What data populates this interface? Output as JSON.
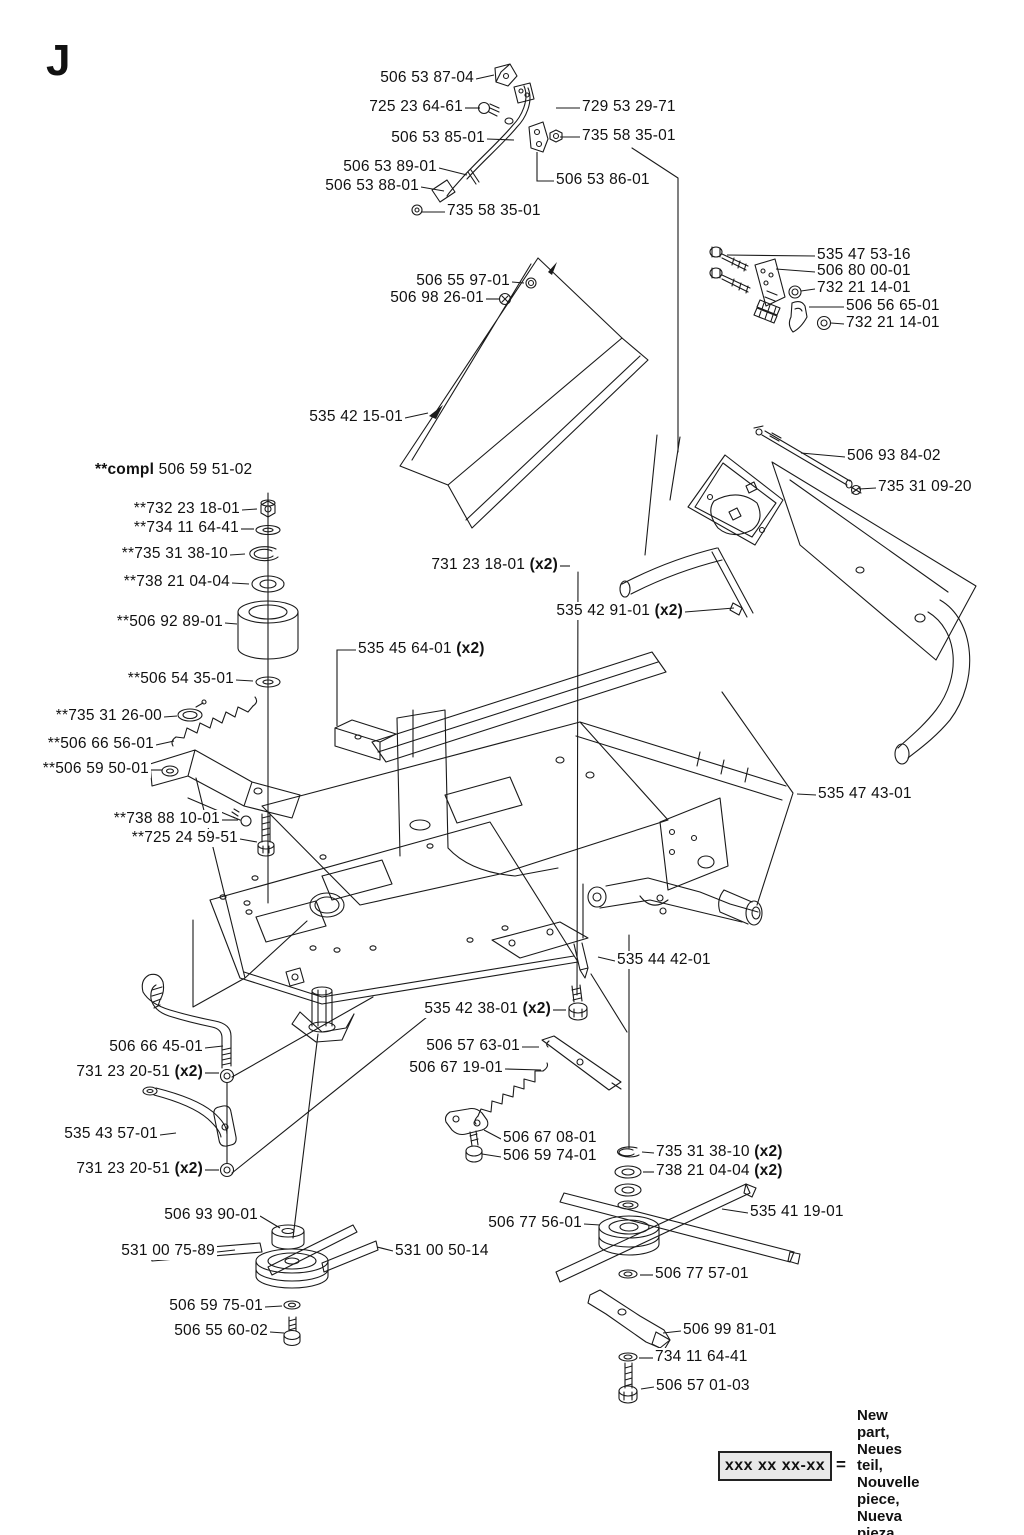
{
  "page": {
    "title_letter": "J",
    "background": "#ffffff",
    "line_color": "#1a1a1a"
  },
  "legend": {
    "box_label": "xxx xx xx-xx",
    "equals": "=",
    "lines": [
      "New part,",
      "Neues teil,",
      "Nouvelle piece,",
      "Nueva pieza,",
      "Ny detalj"
    ]
  },
  "parts_labels": [
    {
      "text": "506 53 87-04",
      "x": 474,
      "y": 79,
      "align": "r",
      "leader": [
        [
          476,
          79
        ],
        [
          494,
          75
        ]
      ]
    },
    {
      "text": "725 23 64-61",
      "x": 463,
      "y": 108,
      "align": "r",
      "leader": [
        [
          465,
          108
        ],
        [
          480,
          108
        ]
      ]
    },
    {
      "text": "729 53 29-71",
      "x": 582,
      "y": 108,
      "align": "l",
      "leader": [
        [
          556,
          108
        ],
        [
          580,
          108
        ]
      ]
    },
    {
      "text": "506 53 85-01",
      "x": 485,
      "y": 139,
      "align": "r",
      "leader": [
        [
          487,
          139
        ],
        [
          514,
          140
        ]
      ]
    },
    {
      "text": "735 58 35-01",
      "x": 582,
      "y": 137,
      "align": "l",
      "leader": [
        [
          560,
          137
        ],
        [
          580,
          137
        ]
      ]
    },
    {
      "text": "506 53 89-01",
      "x": 437,
      "y": 168,
      "align": "r",
      "leader": [
        [
          439,
          168
        ],
        [
          467,
          175
        ]
      ]
    },
    {
      "text": "506 53 88-01",
      "x": 419,
      "y": 187,
      "align": "r",
      "leader": [
        [
          421,
          187
        ],
        [
          444,
          191
        ]
      ]
    },
    {
      "text": "506 53 86-01",
      "x": 556,
      "y": 181,
      "align": "l",
      "leader": [
        [
          537,
          152
        ],
        [
          537,
          181
        ],
        [
          554,
          181
        ]
      ]
    },
    {
      "text": "735 58 35-01",
      "x": 447,
      "y": 212,
      "align": "l",
      "leader": [
        [
          421,
          212
        ],
        [
          445,
          212
        ]
      ]
    },
    {
      "text": "535 47 53-16",
      "x": 817,
      "y": 256,
      "align": "l",
      "leader": [
        [
          727,
          255
        ],
        [
          815,
          256
        ]
      ]
    },
    {
      "text": "506 80 00-01",
      "x": 817,
      "y": 272,
      "align": "l",
      "leader": [
        [
          776,
          269
        ],
        [
          815,
          272
        ]
      ]
    },
    {
      "text": "732 21 14-01",
      "x": 817,
      "y": 289,
      "align": "l",
      "leader": [
        [
          801,
          291
        ],
        [
          815,
          289
        ]
      ]
    },
    {
      "text": "506 56 65-01",
      "x": 846,
      "y": 307,
      "align": "l",
      "leader": [
        [
          809,
          307
        ],
        [
          844,
          307
        ]
      ]
    },
    {
      "text": "732 21 14-01",
      "x": 846,
      "y": 324,
      "align": "l",
      "leader": [
        [
          831,
          323
        ],
        [
          844,
          324
        ]
      ]
    },
    {
      "text": "506 55 97-01",
      "x": 510,
      "y": 282,
      "align": "r",
      "leader": [
        [
          512,
          282
        ],
        [
          524,
          283
        ]
      ]
    },
    {
      "text": "506 98 26-01",
      "x": 484,
      "y": 299,
      "align": "r",
      "leader": [
        [
          486,
          299
        ],
        [
          500,
          299
        ]
      ]
    },
    {
      "text": "535 42 15-01",
      "x": 403,
      "y": 418,
      "align": "r",
      "leader": [
        [
          405,
          418
        ],
        [
          428,
          413
        ]
      ]
    },
    {
      "text": "506 93 84-02",
      "x": 847,
      "y": 457,
      "align": "l",
      "leader": [
        [
          801,
          453
        ],
        [
          845,
          457
        ]
      ]
    },
    {
      "text": "735 31 09-20",
      "x": 878,
      "y": 488,
      "align": "l",
      "leader": [
        [
          859,
          489
        ],
        [
          876,
          488
        ]
      ]
    },
    {
      "pre": "**compl ",
      "text": "506 59 51-02",
      "x": 95,
      "y": 471,
      "align": "l"
    },
    {
      "text": "**732 23 18-01",
      "x": 240,
      "y": 510,
      "align": "r",
      "leader": [
        [
          242,
          510
        ],
        [
          257,
          509
        ]
      ]
    },
    {
      "text": "**734 11 64-41",
      "x": 239,
      "y": 529,
      "align": "r",
      "leader": [
        [
          241,
          529
        ],
        [
          254,
          529
        ]
      ]
    },
    {
      "text": "**735 31 38-10",
      "x": 228,
      "y": 555,
      "align": "r",
      "leader": [
        [
          230,
          555
        ],
        [
          245,
          554
        ]
      ]
    },
    {
      "text": "**738 21 04-04",
      "x": 230,
      "y": 583,
      "align": "r",
      "leader": [
        [
          232,
          583
        ],
        [
          249,
          584
        ]
      ]
    },
    {
      "text": "**506 92 89-01",
      "x": 223,
      "y": 623,
      "align": "r",
      "leader": [
        [
          225,
          623
        ],
        [
          237,
          624
        ]
      ]
    },
    {
      "text": "**506 54 35-01",
      "x": 234,
      "y": 680,
      "align": "r",
      "leader": [
        [
          236,
          680
        ],
        [
          253,
          681
        ]
      ]
    },
    {
      "text": "**735 31 26-00",
      "x": 162,
      "y": 717,
      "align": "r",
      "leader": [
        [
          164,
          717
        ],
        [
          177,
          716
        ]
      ]
    },
    {
      "text": "**506 66 56-01",
      "x": 154,
      "y": 745,
      "align": "r",
      "leader": [
        [
          156,
          745
        ],
        [
          174,
          741
        ]
      ]
    },
    {
      "text": "**506 59 50-01",
      "x": 149,
      "y": 770,
      "align": "r",
      "leader": [
        [
          151,
          770
        ],
        [
          162,
          770
        ]
      ]
    },
    {
      "text": "**738 88 10-01",
      "x": 220,
      "y": 820,
      "align": "r",
      "leader": [
        [
          222,
          820
        ],
        [
          238,
          820
        ]
      ]
    },
    {
      "text": "**725 24 59-51",
      "x": 238,
      "y": 839,
      "align": "r",
      "leader": [
        [
          240,
          839
        ],
        [
          257,
          842
        ]
      ]
    },
    {
      "text": "731 23 18-01 ",
      "post": "(x2)",
      "x": 558,
      "y": 566,
      "align": "r",
      "leader": [
        [
          560,
          566
        ],
        [
          570,
          566
        ]
      ]
    },
    {
      "text": "535 42 91-01 ",
      "post": "(x2)",
      "x": 683,
      "y": 612,
      "align": "r",
      "leader": [
        [
          685,
          612
        ],
        [
          734,
          608
        ]
      ]
    },
    {
      "text": "535 45 64-01 ",
      "post": "(x2)",
      "x": 358,
      "y": 650,
      "align": "l",
      "leader": [
        [
          356,
          650
        ],
        [
          337,
          650
        ],
        [
          337,
          726
        ]
      ]
    },
    {
      "text": "535 47 43-01",
      "x": 818,
      "y": 795,
      "align": "l",
      "leader": [
        [
          797,
          794
        ],
        [
          816,
          795
        ]
      ]
    },
    {
      "text": "535 44 42-01",
      "x": 617,
      "y": 961,
      "align": "l",
      "leader": [
        [
          598,
          957
        ],
        [
          615,
          961
        ]
      ]
    },
    {
      "text": "535 42 38-01 ",
      "post": "(x2)",
      "x": 551,
      "y": 1010,
      "align": "r",
      "leader": [
        [
          553,
          1010
        ],
        [
          566,
          1010
        ]
      ]
    },
    {
      "text": "506 66 45-01",
      "x": 203,
      "y": 1048,
      "align": "r",
      "leader": [
        [
          205,
          1048
        ],
        [
          223,
          1046
        ]
      ]
    },
    {
      "text": "731 23 20-51 ",
      "post": "(x2)",
      "x": 203,
      "y": 1073,
      "align": "r",
      "leader": [
        [
          205,
          1073
        ],
        [
          219,
          1073
        ]
      ]
    },
    {
      "text": "506 57 63-01",
      "x": 520,
      "y": 1047,
      "align": "r",
      "leader": [
        [
          522,
          1047
        ],
        [
          539,
          1047
        ]
      ]
    },
    {
      "text": "506 67 19-01",
      "x": 503,
      "y": 1069,
      "align": "r",
      "leader": [
        [
          505,
          1069
        ],
        [
          541,
          1070
        ]
      ]
    },
    {
      "text": "535 43 57-01",
      "x": 158,
      "y": 1135,
      "align": "r",
      "leader": [
        [
          160,
          1135
        ],
        [
          176,
          1133
        ]
      ]
    },
    {
      "text": "731 23 20-51 ",
      "post": "(x2)",
      "x": 203,
      "y": 1170,
      "align": "r",
      "leader": [
        [
          205,
          1170
        ],
        [
          219,
          1170
        ]
      ]
    },
    {
      "text": "506 67 08-01",
      "x": 503,
      "y": 1139,
      "align": "l",
      "leader": [
        [
          484,
          1130
        ],
        [
          501,
          1139
        ]
      ]
    },
    {
      "text": "506 59 74-01",
      "x": 503,
      "y": 1157,
      "align": "l",
      "leader": [
        [
          482,
          1154
        ],
        [
          501,
          1157
        ]
      ]
    },
    {
      "text": "735 31 38-10 ",
      "post": "(x2)",
      "x": 656,
      "y": 1153,
      "align": "l",
      "leader": [
        [
          642,
          1152
        ],
        [
          654,
          1153
        ]
      ]
    },
    {
      "text": "738 21 04-04 ",
      "post": "(x2)",
      "x": 656,
      "y": 1172,
      "align": "l",
      "leader": [
        [
          643,
          1172
        ],
        [
          654,
          1172
        ]
      ]
    },
    {
      "text": "506 93 90-01",
      "x": 258,
      "y": 1216,
      "align": "r",
      "leader": [
        [
          260,
          1216
        ],
        [
          280,
          1228
        ]
      ]
    },
    {
      "text": "506 77 56-01",
      "x": 582,
      "y": 1224,
      "align": "r",
      "leader": [
        [
          584,
          1224
        ],
        [
          600,
          1225
        ]
      ]
    },
    {
      "text": "535 41 19-01",
      "x": 750,
      "y": 1213,
      "align": "l",
      "leader": [
        [
          722,
          1209
        ],
        [
          748,
          1213
        ]
      ]
    },
    {
      "text": "531 00 75-89",
      "x": 215,
      "y": 1252,
      "align": "r",
      "leader": [
        [
          217,
          1252
        ],
        [
          235,
          1250
        ]
      ]
    },
    {
      "text": "531 00 50-14",
      "x": 395,
      "y": 1252,
      "align": "l",
      "leader": [
        [
          377,
          1247
        ],
        [
          393,
          1251
        ]
      ]
    },
    {
      "text": "506 77 57-01",
      "x": 655,
      "y": 1275,
      "align": "l",
      "leader": [
        [
          640,
          1275
        ],
        [
          653,
          1275
        ]
      ]
    },
    {
      "text": "506 59 75-01",
      "x": 263,
      "y": 1307,
      "align": "r",
      "leader": [
        [
          265,
          1307
        ],
        [
          282,
          1306
        ]
      ]
    },
    {
      "text": "506 55 60-02",
      "x": 268,
      "y": 1332,
      "align": "r",
      "leader": [
        [
          270,
          1332
        ],
        [
          284,
          1333
        ]
      ]
    },
    {
      "text": "506 99 81-01",
      "x": 683,
      "y": 1331,
      "align": "l",
      "leader": [
        [
          663,
          1333
        ],
        [
          681,
          1331
        ]
      ]
    },
    {
      "text": "734 11 64-41",
      "x": 655,
      "y": 1358,
      "align": "l",
      "leader": [
        [
          639,
          1358
        ],
        [
          653,
          1358
        ]
      ]
    },
    {
      "text": "506 57 01-03",
      "x": 656,
      "y": 1387,
      "align": "l",
      "leader": [
        [
          641,
          1389
        ],
        [
          654,
          1387
        ]
      ]
    }
  ]
}
